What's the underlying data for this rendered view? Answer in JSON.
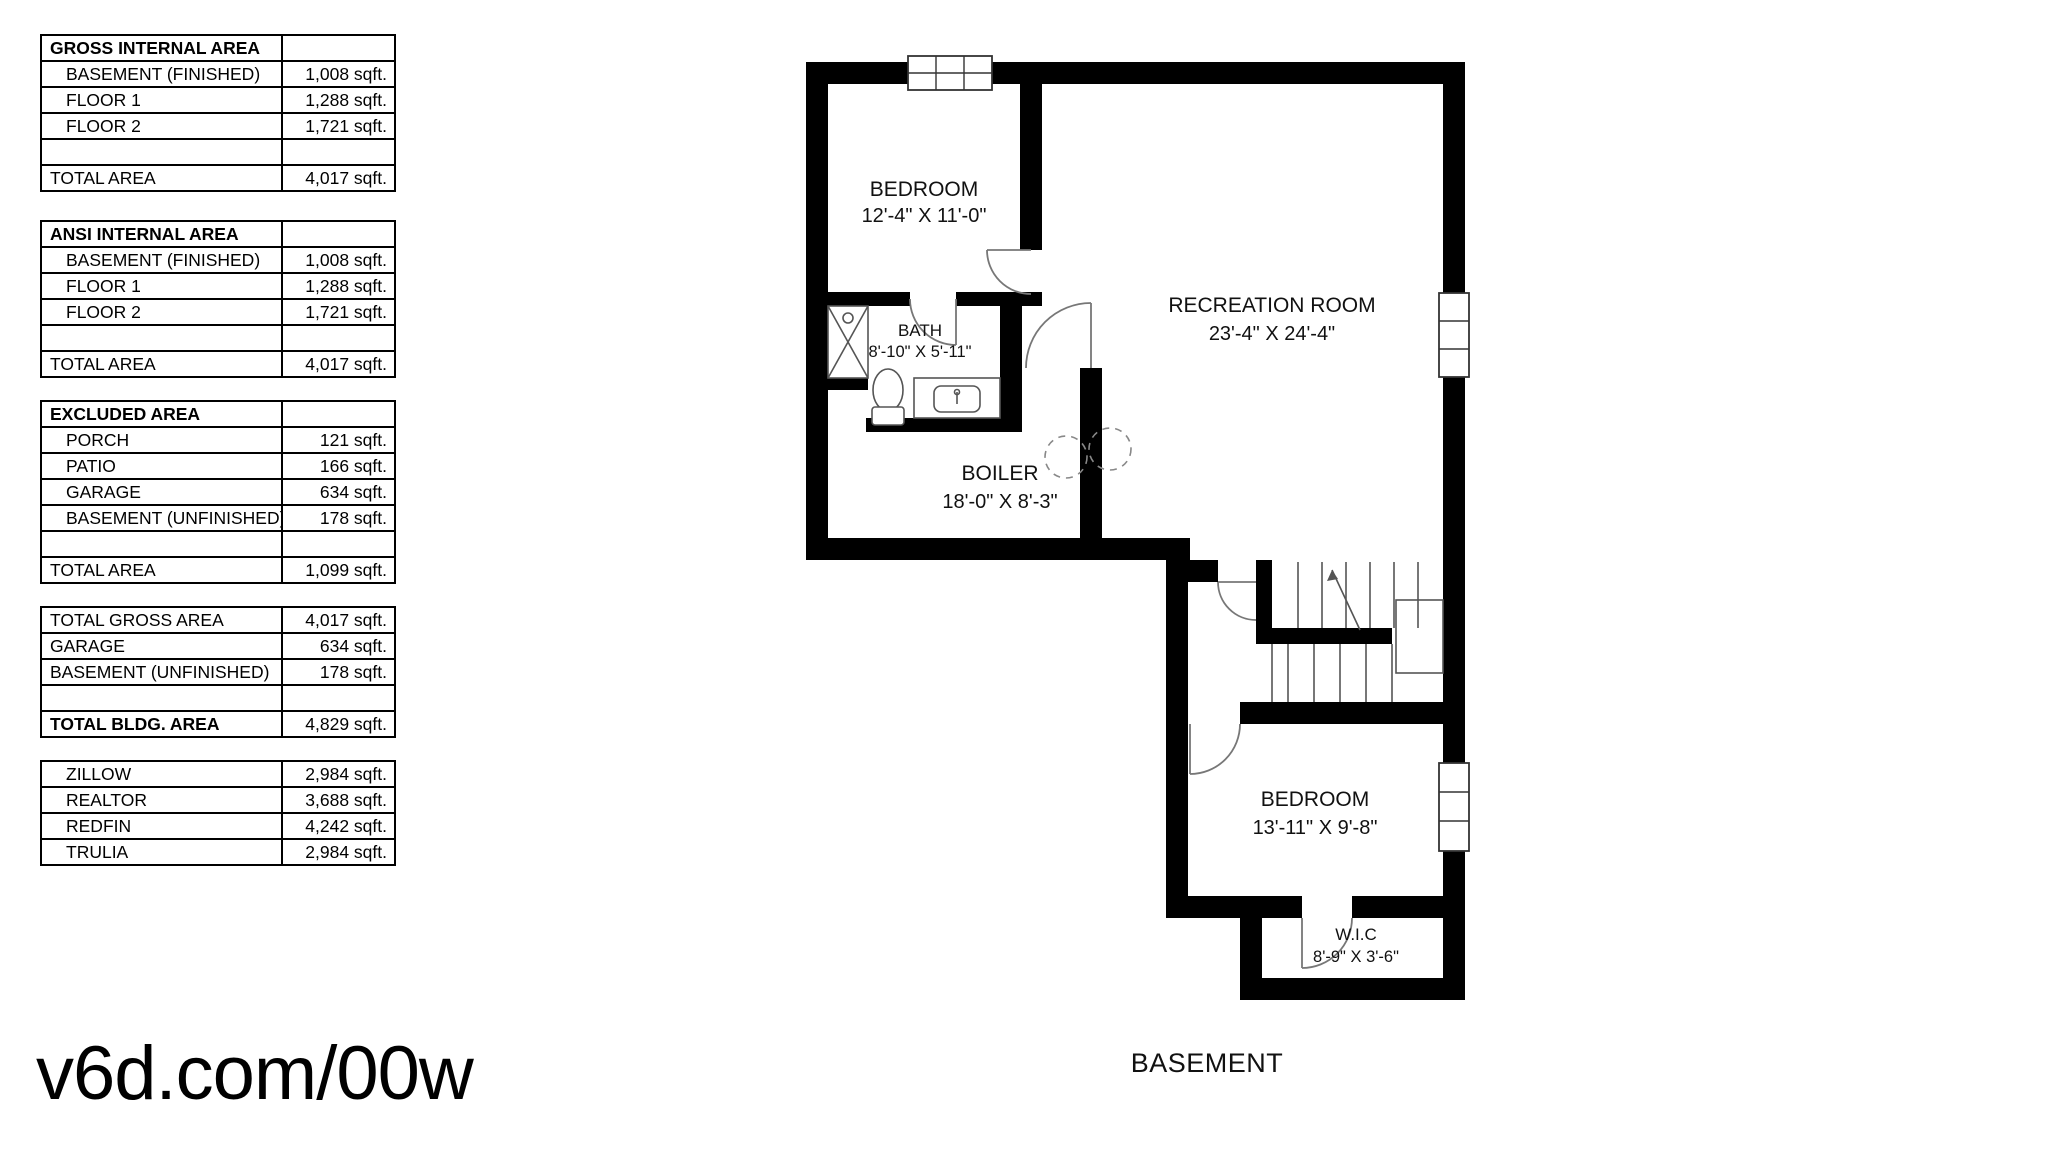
{
  "page": {
    "watermark": "v6d.com/00w",
    "background": "#ffffff",
    "wall_color": "#000000"
  },
  "tables": [
    {
      "id": "gross-internal-area",
      "header": "GROSS INTERNAL AREA",
      "rows": [
        {
          "label": "BASEMENT (FINISHED)",
          "value": "1,008 sqft."
        },
        {
          "label": "FLOOR 1",
          "value": "1,288 sqft."
        },
        {
          "label": "FLOOR 2",
          "value": "1,721 sqft."
        },
        {
          "label": "",
          "value": ""
        },
        {
          "label": "TOTAL AREA",
          "value": "4,017 sqft."
        }
      ]
    },
    {
      "id": "ansi-internal-area",
      "header": "ANSI INTERNAL AREA",
      "rows": [
        {
          "label": "BASEMENT (FINISHED)",
          "value": "1,008 sqft."
        },
        {
          "label": "FLOOR 1",
          "value": "1,288 sqft."
        },
        {
          "label": "FLOOR 2",
          "value": "1,721 sqft."
        },
        {
          "label": "",
          "value": ""
        },
        {
          "label": "TOTAL AREA",
          "value": "4,017 sqft."
        }
      ]
    },
    {
      "id": "excluded-area",
      "header": "EXCLUDED AREA",
      "rows": [
        {
          "label": "PORCH",
          "value": "121 sqft."
        },
        {
          "label": "PATIO",
          "value": "166 sqft."
        },
        {
          "label": "GARAGE",
          "value": "634 sqft."
        },
        {
          "label": "BASEMENT (UNFINISHED)",
          "value": "178 sqft."
        },
        {
          "label": "",
          "value": ""
        },
        {
          "label": "TOTAL AREA",
          "value": "1,099 sqft."
        }
      ]
    },
    {
      "id": "building-totals",
      "rows": [
        {
          "label": "TOTAL GROSS AREA",
          "value": "4,017 sqft."
        },
        {
          "label": "GARAGE",
          "value": "634 sqft."
        },
        {
          "label": "BASEMENT (UNFINISHED)",
          "value": "178 sqft."
        },
        {
          "label": "",
          "value": ""
        },
        {
          "label": "TOTAL BLDG. AREA",
          "value": "4,829 sqft."
        }
      ]
    },
    {
      "id": "listing-estimates",
      "rows": [
        {
          "label": "ZILLOW",
          "value": "2,984 sqft."
        },
        {
          "label": "REALTOR",
          "value": "3,688 sqft."
        },
        {
          "label": "REDFIN",
          "value": "4,242 sqft."
        },
        {
          "label": "TRULIA",
          "value": "2,984 sqft."
        }
      ]
    }
  ],
  "floor_plan": {
    "title": "BASEMENT",
    "rooms": [
      {
        "name": "BEDROOM",
        "dims": "12'-4\" X 11'-0\""
      },
      {
        "name": "RECREATION ROOM",
        "dims": "23'-4\" X 24'-4\""
      },
      {
        "name": "BATH",
        "dims": "8'-10\" X 5'-11\""
      },
      {
        "name": "BOILER",
        "dims": "18'-0\" X 8'-3\""
      },
      {
        "name": "BEDROOM",
        "dims": "13'-11\" X 9'-8\""
      },
      {
        "name": "W.I.C",
        "dims": "8'-9\" X 3'-6\""
      }
    ]
  }
}
